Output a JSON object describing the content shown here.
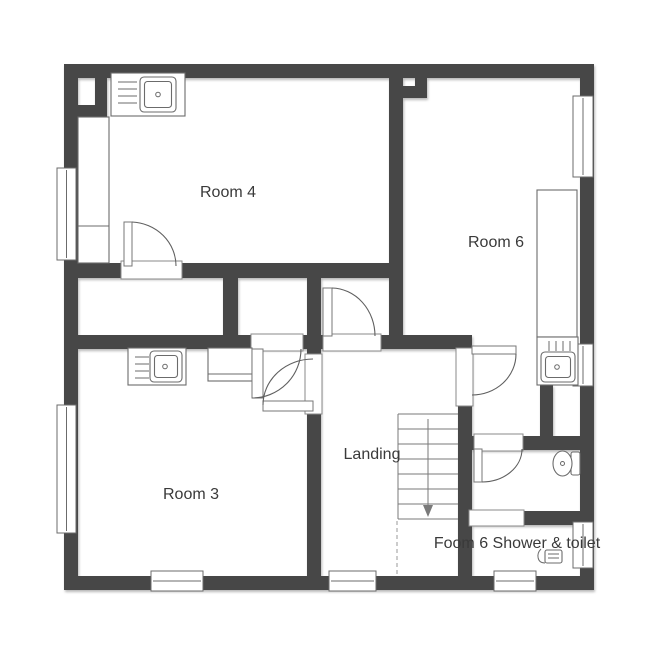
{
  "floor_plan": {
    "rooms": [
      {
        "name": "Room 4"
      },
      {
        "name": "Room 6"
      },
      {
        "name": "Room 3"
      },
      {
        "name": "Landing"
      },
      {
        "name": "Foom 6 Shower & toilet"
      }
    ],
    "stairs": {
      "direction": "down",
      "visible_treads": 8
    },
    "icons": [
      "kitchen-sink-icon",
      "kitchen-sink-icon",
      "sink-icon",
      "toilet-icon",
      "shower-icon",
      "stairs-down-arrow-icon"
    ],
    "colors": {
      "wall": "#474747",
      "background": "#ffffff",
      "fixture_line": "#6b6b6b",
      "text": "#3a3a3a"
    }
  }
}
